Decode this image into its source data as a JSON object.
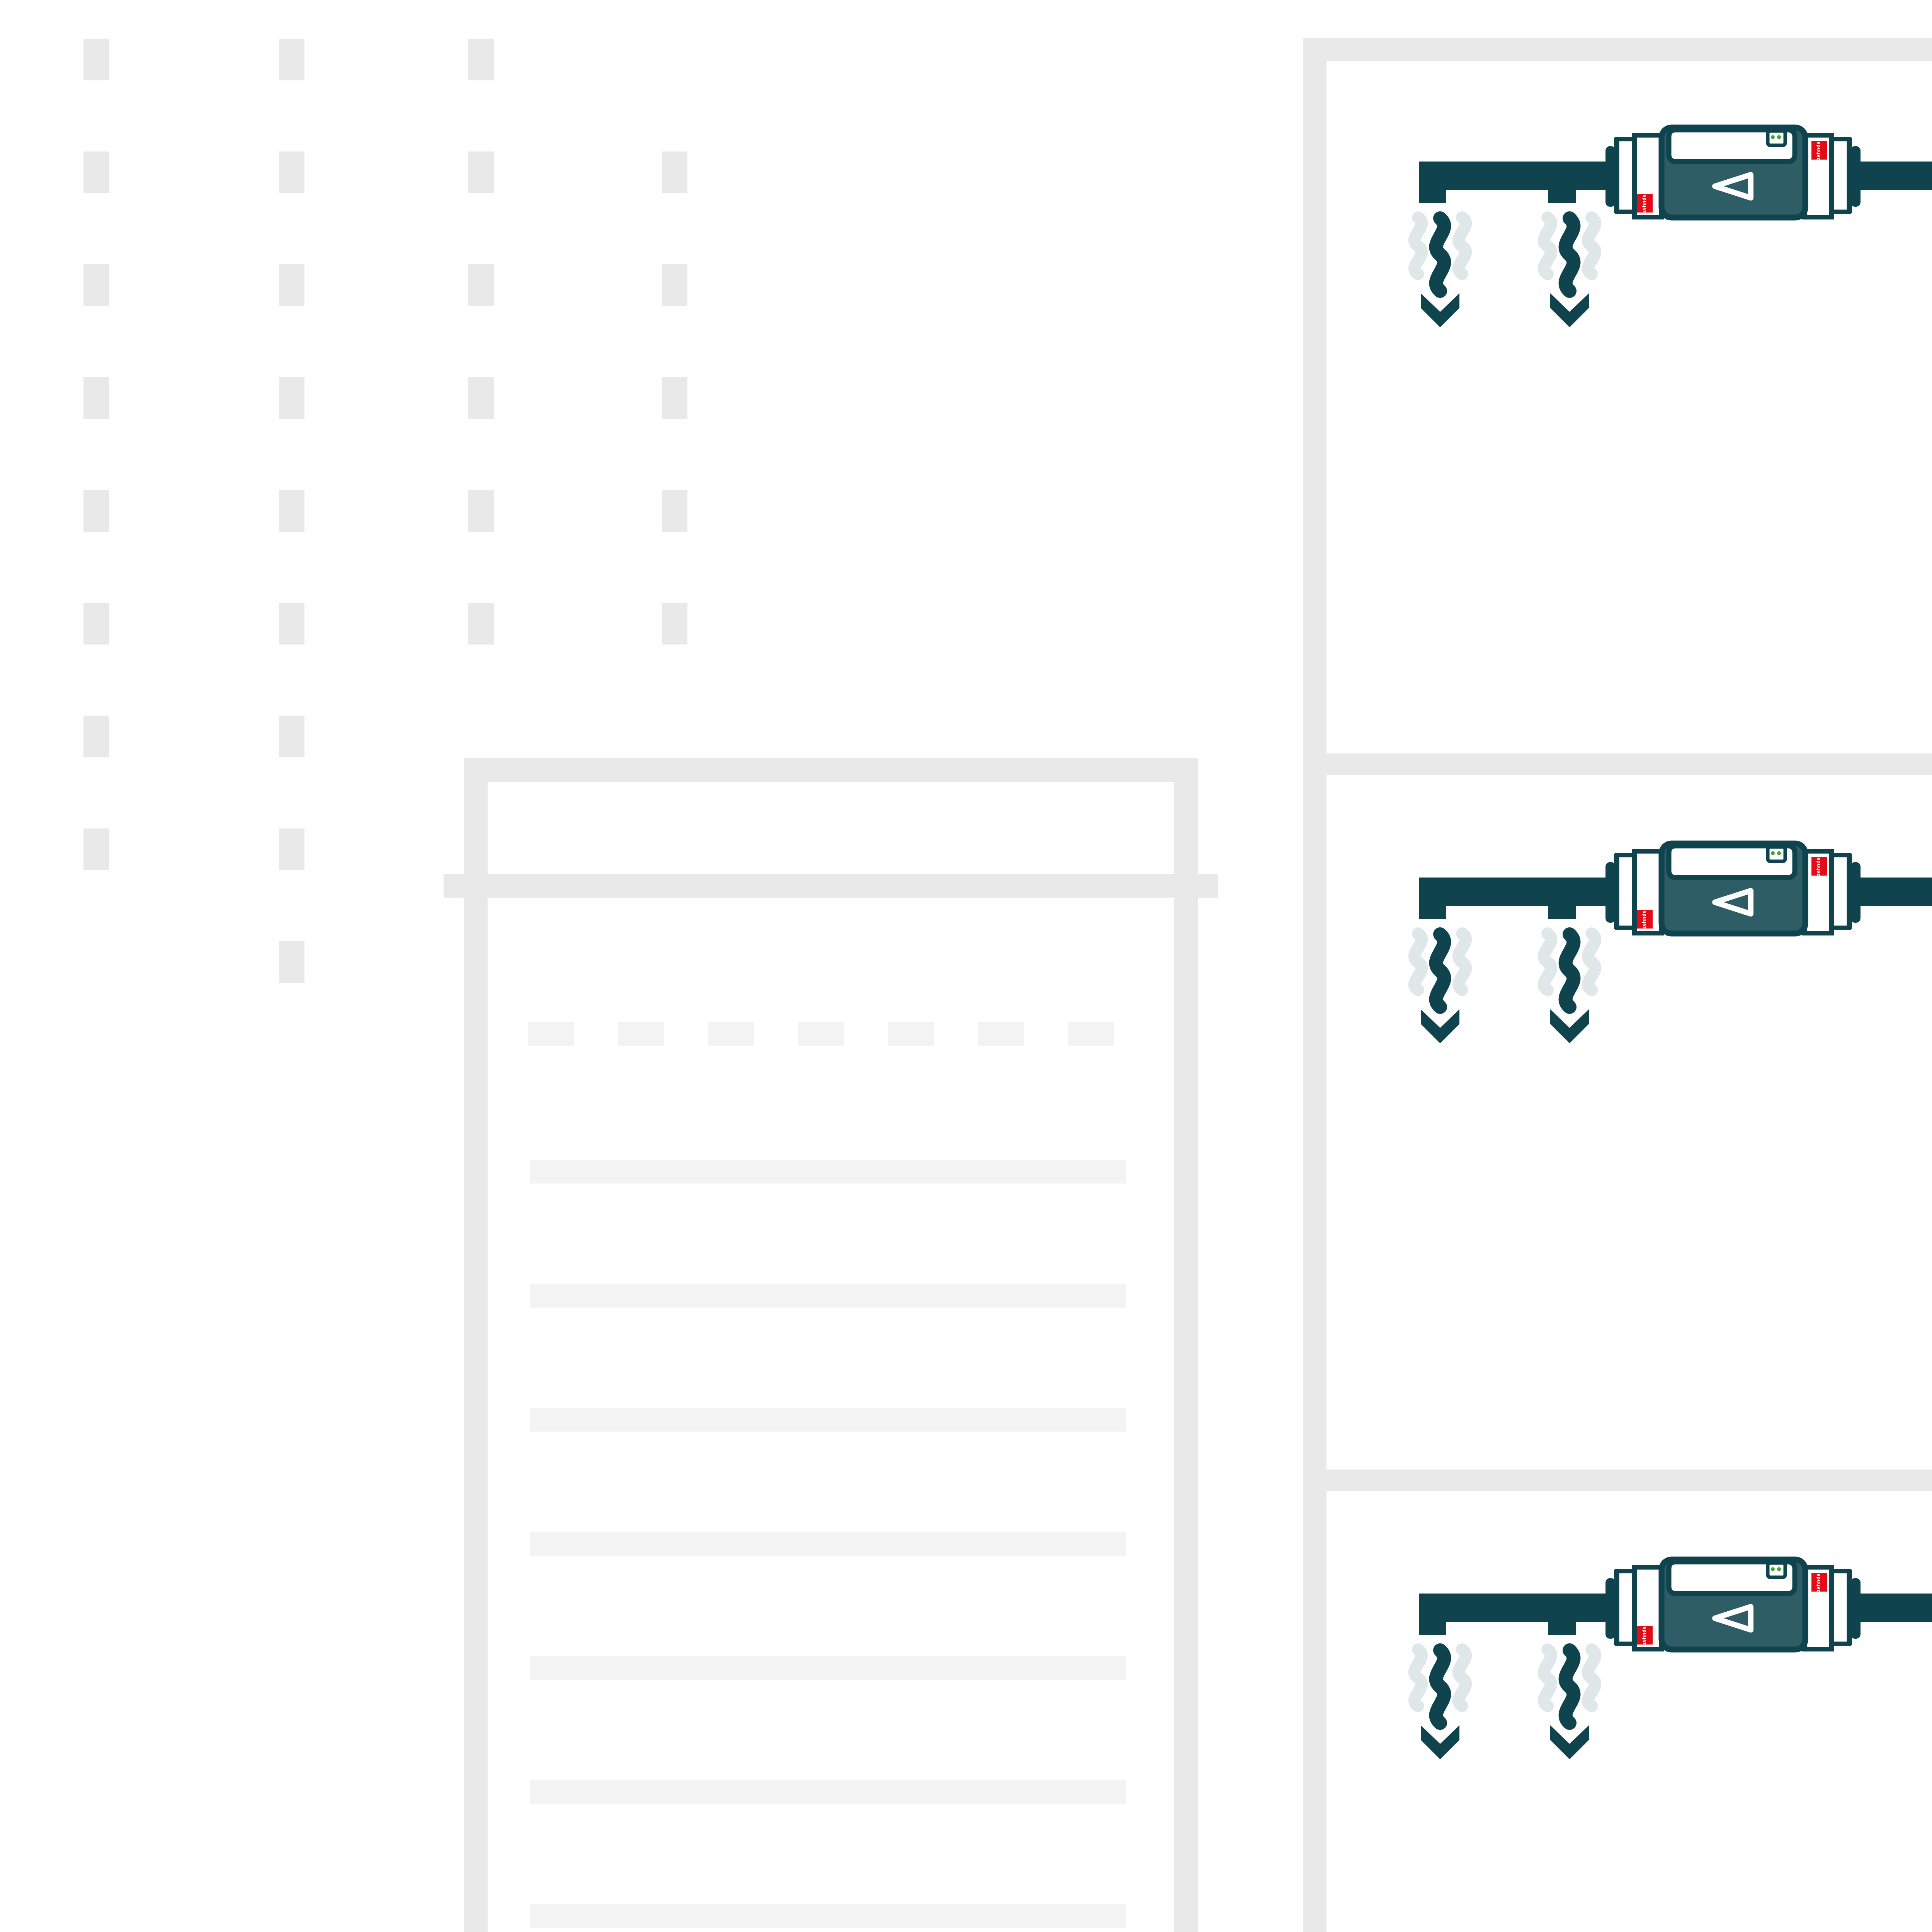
{
  "brand": {
    "label": "zehnder"
  },
  "palette": {
    "teal-dark": "#0f434d",
    "teal-body": "#2e5d65",
    "teal-faint": "#dfe7e9",
    "red": "#e30b17",
    "red-faint": "#fae6e0",
    "decor": "#e9e9e9",
    "decor-light": "#f3f3f3",
    "bracket": "#7fa1a5",
    "green": "#3aaa35",
    "ground": "#eaeaea",
    "white": "#ffffff"
  },
  "diagram": {
    "type": "building-ventilation-scheme",
    "floors_with_units": 3,
    "units_per_floor": 2,
    "extract_side": {
      "position": "left",
      "duct_color": "teal-dark",
      "airflow": "down"
    },
    "supply_side": {
      "position": "right",
      "duct_color": "red",
      "airflow": "up"
    },
    "risers": [
      "teal-dark",
      "red"
    ],
    "base_unit": {
      "shape": "rounded-box-in-bracket",
      "color": "teal-dark"
    }
  },
  "floors": [
    {
      "id": 1,
      "dy": 0
    },
    {
      "id": 2,
      "dy": 1853
    },
    {
      "id": 3,
      "dy": 3706
    }
  ],
  "decor": {
    "dash_columns": {
      "y0": 100,
      "pitch": 292,
      "w": 66,
      "h": 108,
      "columns": [
        {
          "x": 216,
          "first": 0,
          "count": 8
        },
        {
          "x": 722,
          "first": 0,
          "count": 9
        },
        {
          "x": 1212,
          "first": 0,
          "count": 6
        },
        {
          "x": 1713,
          "first": 1,
          "count": 5
        }
      ]
    },
    "window_dashes": {
      "x0": 1366,
      "y": 2645,
      "w": 119,
      "h": 61,
      "gap": 114,
      "count": 7
    },
    "floor_lines": {
      "x": 1372,
      "w": 1542,
      "y0": 3002,
      "pitch": 321,
      "h": 61,
      "count": 14
    }
  }
}
